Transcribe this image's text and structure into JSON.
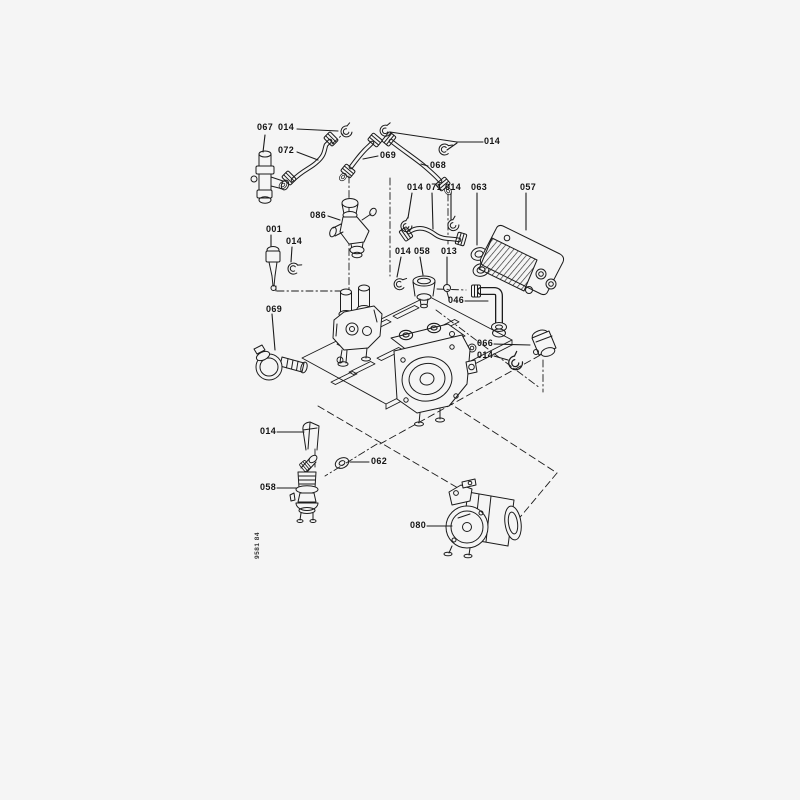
{
  "diagram": {
    "doc_number": "9581 84",
    "colors": {
      "ink": "#1c1c1c",
      "background": "#f5f5f5"
    },
    "labels": [
      {
        "text": "067"
      },
      {
        "text": "014"
      },
      {
        "text": "072"
      },
      {
        "text": "069"
      },
      {
        "text": "068"
      },
      {
        "text": "014"
      },
      {
        "text": "014"
      },
      {
        "text": "071"
      },
      {
        "text": "014"
      },
      {
        "text": "063"
      },
      {
        "text": "057"
      },
      {
        "text": "086"
      },
      {
        "text": "001"
      },
      {
        "text": "014"
      },
      {
        "text": "014"
      },
      {
        "text": "058"
      },
      {
        "text": "013"
      },
      {
        "text": "046"
      },
      {
        "text": "066"
      },
      {
        "text": "014"
      },
      {
        "text": "069"
      },
      {
        "text": "014"
      },
      {
        "text": "062"
      },
      {
        "text": "058"
      },
      {
        "text": "080"
      }
    ]
  }
}
